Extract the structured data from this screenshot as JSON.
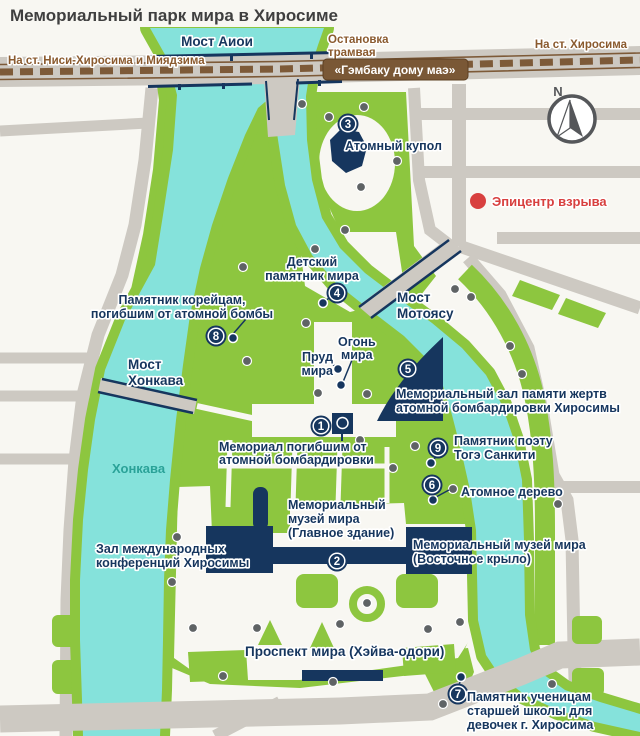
{
  "colors": {
    "bg": "#f8f7f2",
    "green": "#8dc63f",
    "river": "#85e2db",
    "road": "#cdc9c2",
    "navy": "#16365e",
    "brown": "#8a5a2e",
    "badge": "#7a5836",
    "rail": "#7d5a38",
    "red": "#d8403f",
    "dot": "#5f6365",
    "title": "#3f3f3f",
    "teal": "#2aa298",
    "compass": "#55575a"
  },
  "title": "Мемориальный парк мира в Хиросиме",
  "directions": {
    "west": "На ст. Ниси-Хиросима и Миядзима",
    "east": "На ст. Хиросима"
  },
  "tram": {
    "stop": [
      "Остановка",
      "трамвая"
    ],
    "station_badge": "«Гэмбаку дому маэ»"
  },
  "bridges": {
    "aioi": "Мост Аиои",
    "honkawa": [
      "Мост",
      "Хонкава"
    ],
    "motoyasu": [
      "Мост",
      "Мотоясу"
    ]
  },
  "rivers": {
    "honkawa": "Хонкава"
  },
  "compass": {
    "north": "N"
  },
  "epicenter": "Эпицентр взрыва",
  "labels": {
    "atomic_dome": "Атомный купол",
    "children_monument": [
      "Детский",
      "памятник мира"
    ],
    "korean_monument": [
      "Памятник корейцам,",
      "погибшим от атомной бомбы"
    ],
    "peace_pond": [
      "Пруд",
      "мира"
    ],
    "peace_flame": [
      "Огонь",
      "мира"
    ],
    "memorial_hall": [
      "Мемориальный зал памяти жертв",
      "атомной бомбардировки Хиросимы"
    ],
    "cenotaph": [
      "Мемориал погибшим от",
      "атомной бомбардировки"
    ],
    "poet_monument": [
      "Памятник поэту",
      "Тогэ Санкити"
    ],
    "atomic_tree": "Атомное дерево",
    "museum_main": [
      "Мемориальный",
      "музей мира",
      "(Главное здание)"
    ],
    "conference_hall": [
      "Зал международных",
      "конференций Хиросимы"
    ],
    "museum_east": [
      "Мемориальный музей мира",
      "(Восточное крыло)"
    ],
    "peace_boulevard": "Проспект мира (Хэйва-одори)",
    "school_monument": [
      "Памятник ученицам",
      "старшей школы для",
      "девочек г. Хиросима"
    ]
  },
  "markers": {
    "m1": "1",
    "m2": "2",
    "m3": "3",
    "m4": "4",
    "m5": "5",
    "m6": "6",
    "m7": "7",
    "m8": "8",
    "m9": "9"
  }
}
